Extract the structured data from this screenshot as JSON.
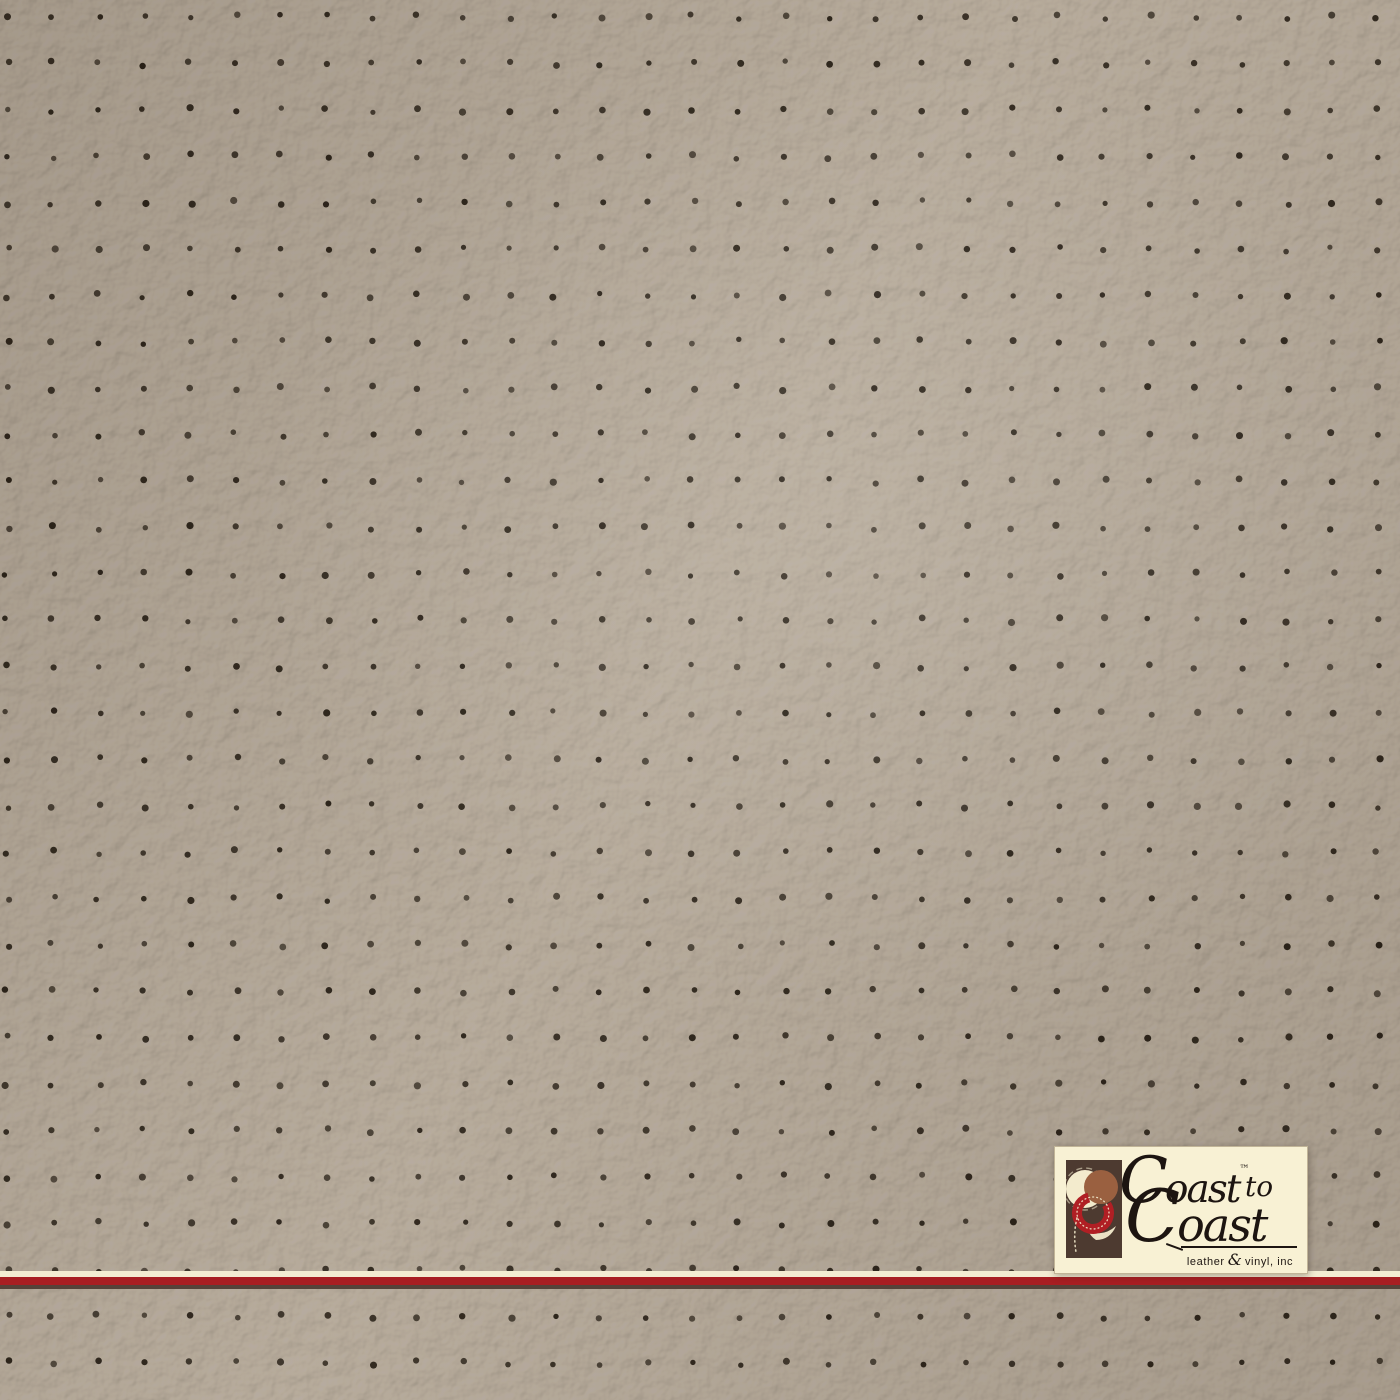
{
  "brand": {
    "line1_initial": "C",
    "line1_rest": "oast",
    "trademark": "™",
    "line1_suffix": "to",
    "line2_initial": "C",
    "line2_rest": "oast",
    "tagline_left": "leather",
    "tagline_amp": "&",
    "tagline_right": "vinyl, inc"
  },
  "colors": {
    "leather_base": "#afa497",
    "perforation_dot": "#241c12",
    "logo_background": "#f8f1d4",
    "logo_text": "#1d1511",
    "logo_mark_rect": "#4d3a30",
    "logo_mark_rust": "#9a6040",
    "logo_mark_cream": "#f3ebcd",
    "logo_mark_red": "#b01f24",
    "stripe_cream": "#f3ecd2",
    "stripe_red": "#a81e22",
    "stripe_dark": "#564239"
  },
  "texture": {
    "material": "perforated leather vinyl swatch",
    "dot_grid": {
      "origin_x": 7,
      "origin_y": 17,
      "spacing_x": 45.7,
      "spacing_y": 46.4,
      "jitter": 2.6,
      "dot_radius_min": 2.6,
      "dot_radius_max": 3.6,
      "columns": 31,
      "rows": 31
    }
  }
}
